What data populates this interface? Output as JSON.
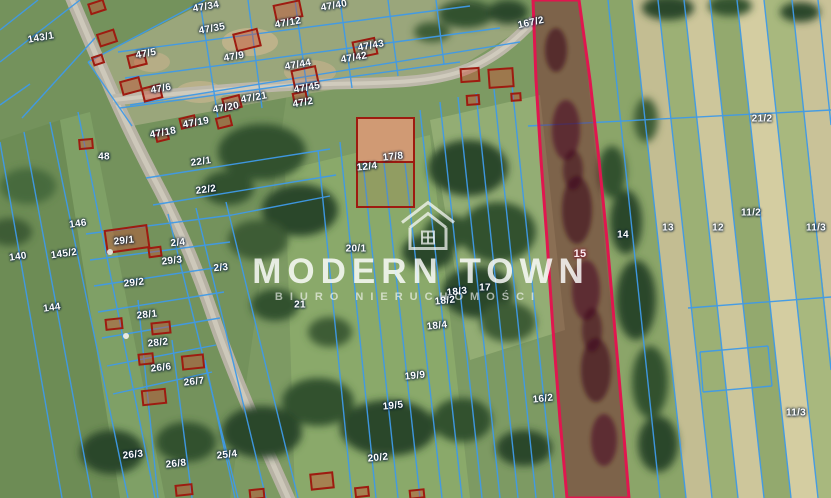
{
  "map": {
    "type": "cadastral-aerial-map",
    "watermark": {
      "brand": "MODERN TOWN",
      "subtitle": "BIURO NIERUCHOMOŚCI",
      "logo": "house-roof-logo"
    },
    "colors": {
      "parcel_boundary": "#3f9ae8",
      "building_outline": "#9e1b10",
      "highlight_outline": "#e0164f",
      "highlight_fill": "rgba(125,18,38,0.40)",
      "label_text": "#ffffff"
    },
    "highlighted_parcel": {
      "number": "15"
    },
    "parcel_labels": [
      {
        "t": "143/1",
        "x": 41,
        "y": 38,
        "r": -10
      },
      {
        "t": "47/34",
        "x": 206,
        "y": 7,
        "r": -10
      },
      {
        "t": "47/35",
        "x": 212,
        "y": 29,
        "r": -10
      },
      {
        "t": "47/40",
        "x": 334,
        "y": 6,
        "r": -10
      },
      {
        "t": "47/12",
        "x": 288,
        "y": 23,
        "r": -10
      },
      {
        "t": "47/5",
        "x": 146,
        "y": 54,
        "r": -10
      },
      {
        "t": "47/9",
        "x": 234,
        "y": 57,
        "r": -10
      },
      {
        "t": "47/43",
        "x": 371,
        "y": 46,
        "r": -10
      },
      {
        "t": "47/42",
        "x": 354,
        "y": 58,
        "r": -10
      },
      {
        "t": "47/44",
        "x": 298,
        "y": 65,
        "r": -10
      },
      {
        "t": "47/6",
        "x": 161,
        "y": 89,
        "r": -10
      },
      {
        "t": "47/45",
        "x": 307,
        "y": 88,
        "r": -10
      },
      {
        "t": "47/2",
        "x": 303,
        "y": 103,
        "r": -10
      },
      {
        "t": "47/21",
        "x": 254,
        "y": 98,
        "r": -10
      },
      {
        "t": "47/20",
        "x": 226,
        "y": 108,
        "r": -10
      },
      {
        "t": "47/19",
        "x": 196,
        "y": 123,
        "r": -10
      },
      {
        "t": "47/18",
        "x": 163,
        "y": 133,
        "r": -10
      },
      {
        "t": "167/2",
        "x": 531,
        "y": 23,
        "r": -12
      },
      {
        "t": "48",
        "x": 104,
        "y": 157,
        "r": 0
      },
      {
        "t": "22/1",
        "x": 201,
        "y": 162,
        "r": -8
      },
      {
        "t": "22/2",
        "x": 206,
        "y": 190,
        "r": -8
      },
      {
        "t": "146",
        "x": 78,
        "y": 224,
        "r": -8
      },
      {
        "t": "145/2",
        "x": 64,
        "y": 254,
        "r": -8
      },
      {
        "t": "140",
        "x": 18,
        "y": 257,
        "r": -8
      },
      {
        "t": "144",
        "x": 52,
        "y": 308,
        "r": -8
      },
      {
        "t": "29/1",
        "x": 124,
        "y": 241,
        "r": -6
      },
      {
        "t": "2/4",
        "x": 178,
        "y": 243,
        "r": -6
      },
      {
        "t": "29/3",
        "x": 172,
        "y": 261,
        "r": -6
      },
      {
        "t": "2/3",
        "x": 221,
        "y": 268,
        "r": -6
      },
      {
        "t": "29/2",
        "x": 134,
        "y": 283,
        "r": -6
      },
      {
        "t": "28/1",
        "x": 147,
        "y": 315,
        "r": -6
      },
      {
        "t": "28/2",
        "x": 158,
        "y": 343,
        "r": -6
      },
      {
        "t": "26/6",
        "x": 161,
        "y": 368,
        "r": -6
      },
      {
        "t": "26/7",
        "x": 194,
        "y": 382,
        "r": -6
      },
      {
        "t": "26/3",
        "x": 133,
        "y": 455,
        "r": -6
      },
      {
        "t": "26/8",
        "x": 176,
        "y": 464,
        "r": -6
      },
      {
        "t": "25/4",
        "x": 227,
        "y": 455,
        "r": -6
      },
      {
        "t": "21",
        "x": 300,
        "y": 305,
        "r": 0
      },
      {
        "t": "20/1",
        "x": 356,
        "y": 249,
        "r": 0
      },
      {
        "t": "12/4",
        "x": 367,
        "y": 167,
        "r": -6
      },
      {
        "t": "17/8",
        "x": 393,
        "y": 157,
        "r": -6
      },
      {
        "t": "18/3",
        "x": 457,
        "y": 292,
        "r": -6
      },
      {
        "t": "18/2",
        "x": 445,
        "y": 301,
        "r": -6
      },
      {
        "t": "17",
        "x": 485,
        "y": 288,
        "r": 0
      },
      {
        "t": "18/4",
        "x": 437,
        "y": 326,
        "r": -6
      },
      {
        "t": "19/9",
        "x": 415,
        "y": 376,
        "r": -6
      },
      {
        "t": "19/5",
        "x": 393,
        "y": 406,
        "r": -6
      },
      {
        "t": "20/2",
        "x": 378,
        "y": 458,
        "r": -6
      },
      {
        "t": "16/2",
        "x": 543,
        "y": 399,
        "r": -6
      },
      {
        "t": "15",
        "x": 580,
        "y": 254,
        "r": 0,
        "h": true
      },
      {
        "t": "14",
        "x": 623,
        "y": 235,
        "r": 0
      },
      {
        "t": "13",
        "x": 668,
        "y": 228,
        "r": 0
      },
      {
        "t": "12",
        "x": 718,
        "y": 228,
        "r": 0
      },
      {
        "t": "21/2",
        "x": 762,
        "y": 119,
        "r": 0
      },
      {
        "t": "11/2",
        "x": 751,
        "y": 213,
        "r": 0
      },
      {
        "t": "11/3",
        "x": 816,
        "y": 228,
        "r": 0
      },
      {
        "t": "11/3",
        "x": 796,
        "y": 413,
        "r": 0
      }
    ]
  }
}
